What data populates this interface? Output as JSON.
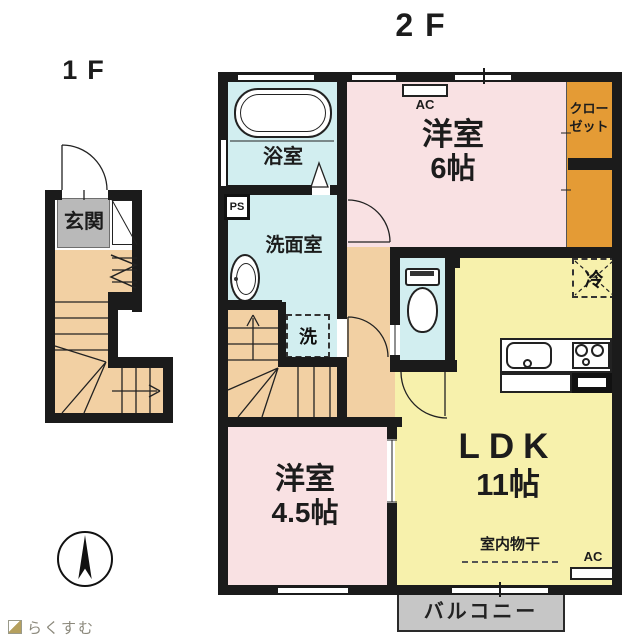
{
  "floors": {
    "second": "2F",
    "first": "1F"
  },
  "rooms": {
    "bath": "浴室",
    "washroom": "洗面室",
    "west6": {
      "name": "洋室",
      "size": "6帖"
    },
    "closet": {
      "line1": "クロー",
      "line2": "ゼット"
    },
    "ldk": {
      "name": "LDK",
      "size": "11帖"
    },
    "west45": {
      "name": "洋室",
      "size": "4.5帖"
    },
    "entrance": "玄関",
    "balcony": "バルコニー"
  },
  "equipment": {
    "ac": "AC",
    "ps": "PS",
    "fridge": "冷",
    "washer": "洗",
    "indoor_drying": "室内物干"
  },
  "branding": {
    "logo": "らくすむ"
  },
  "colors": {
    "wall": "#1b1b1b",
    "room_pink": "#f9e1e3",
    "room_yellow": "#f7f1ac",
    "room_cyan": "#d2eef0",
    "room_peach": "#f2d0a3",
    "closet_orange": "#e49b35",
    "entrance_gray": "#b9b9b9",
    "balcony_gray": "#c6c6c6"
  }
}
